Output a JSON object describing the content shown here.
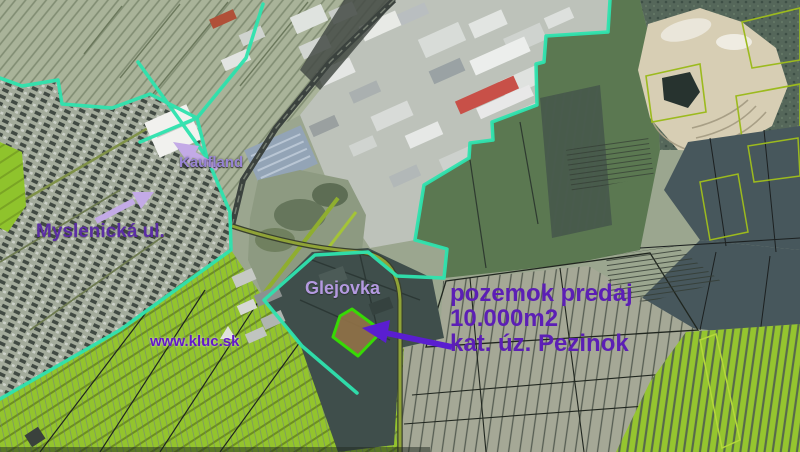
{
  "map": {
    "type": "satellite-cadastral-map",
    "labels": {
      "kaufland": "Kaufland",
      "street": "Myslenická ul.",
      "glejovka": "Glejovka",
      "website": "www.kluc.sk",
      "listing": {
        "line1": "pozemok predaj",
        "line2": "10.000m2",
        "line3": "kat. úz. Pezinok"
      }
    },
    "colors": {
      "boundary_cyan": "#2ee3ae",
      "parcel_highlight_lime": "#37d905",
      "parcel_highlight_fill": "#8f7147",
      "label_light_purple": "#b49ae0",
      "label_medium_purple": "#9884d4",
      "label_dark_purple": "#5b2da5",
      "listing_purple": "#5c1fb5",
      "website_purple": "#6318c8",
      "arrow_light_purple": "#c3aae6",
      "arrow_strong_purple": "#5a1ed0",
      "field_bright_green": "#93c42d",
      "field_dark_green": "#5b7851",
      "parcel_outline_olive": "#9cba1e"
    }
  }
}
